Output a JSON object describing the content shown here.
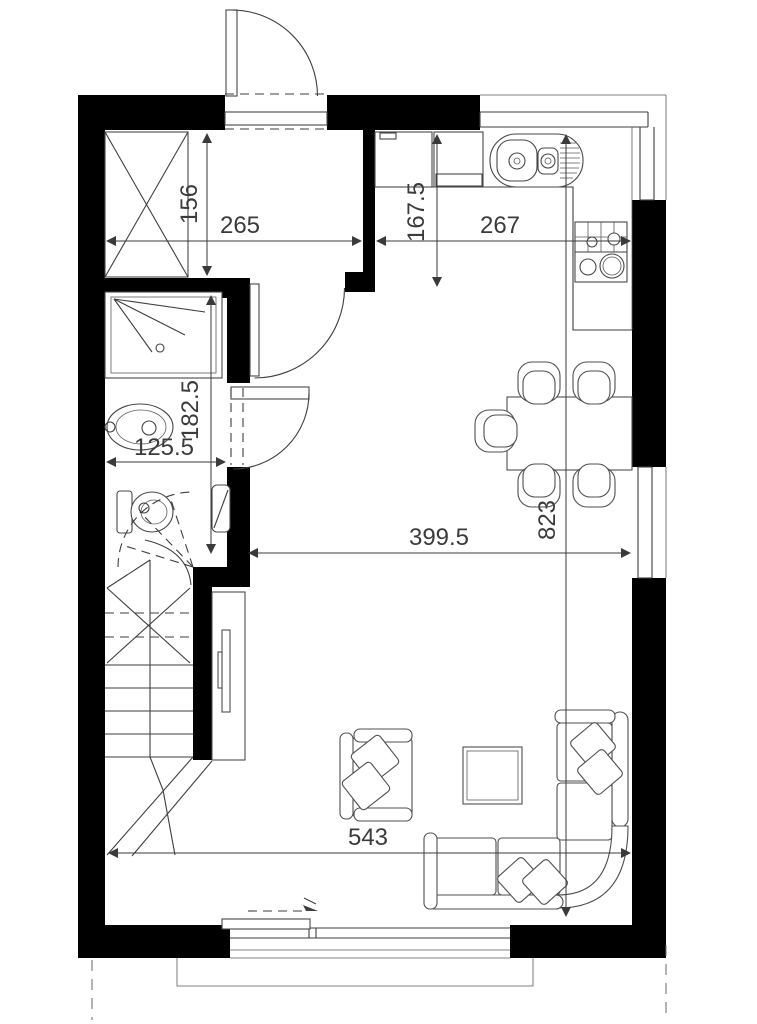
{
  "title": "Apartment floor plan",
  "colors": {
    "wall": "#000000",
    "line": "#3e3e3e",
    "dimension": "#3a3a3a",
    "background": "#ffffff"
  },
  "dimensions": {
    "wardrobe_depth": "156",
    "entry_width": "265",
    "kitchen_width": "267",
    "kitchen_depth": "167.5",
    "bathroom_length": "182.5",
    "bathroom_width": "125.5",
    "living_width": "399.5",
    "interior_length": "823",
    "living_width_bottom": "543"
  }
}
